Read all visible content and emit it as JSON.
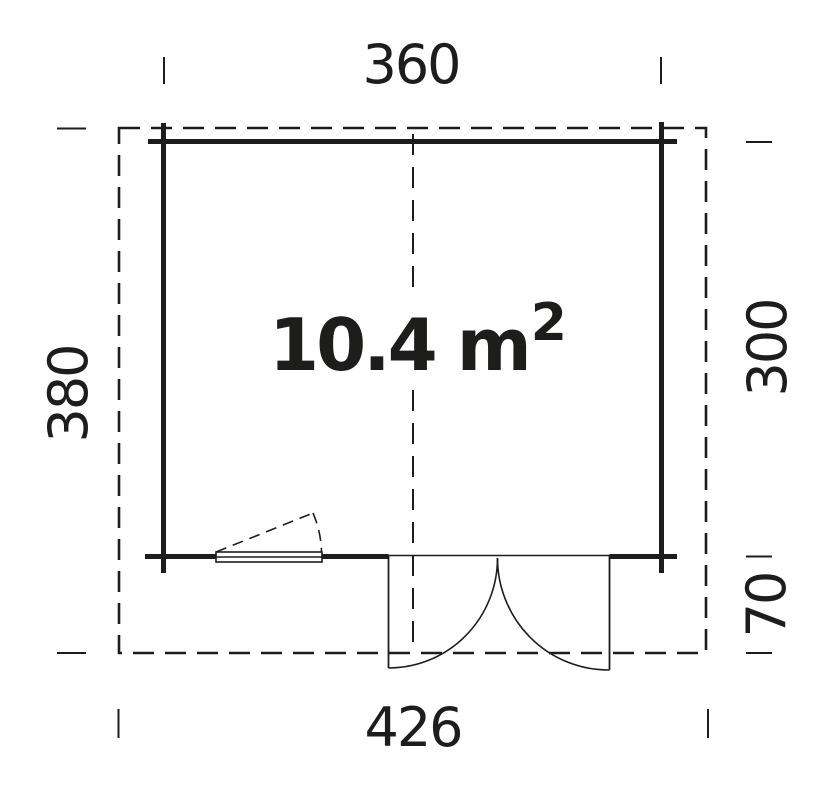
{
  "drawing": {
    "area_label": {
      "value": "10.4 m",
      "exponent": "2"
    },
    "dimensions": {
      "top": "360",
      "bottom": "426",
      "left": "380",
      "right_upper": "300",
      "right_lower": "70"
    },
    "colors": {
      "line": "#1d1d1b",
      "background": "#ffffff"
    }
  }
}
